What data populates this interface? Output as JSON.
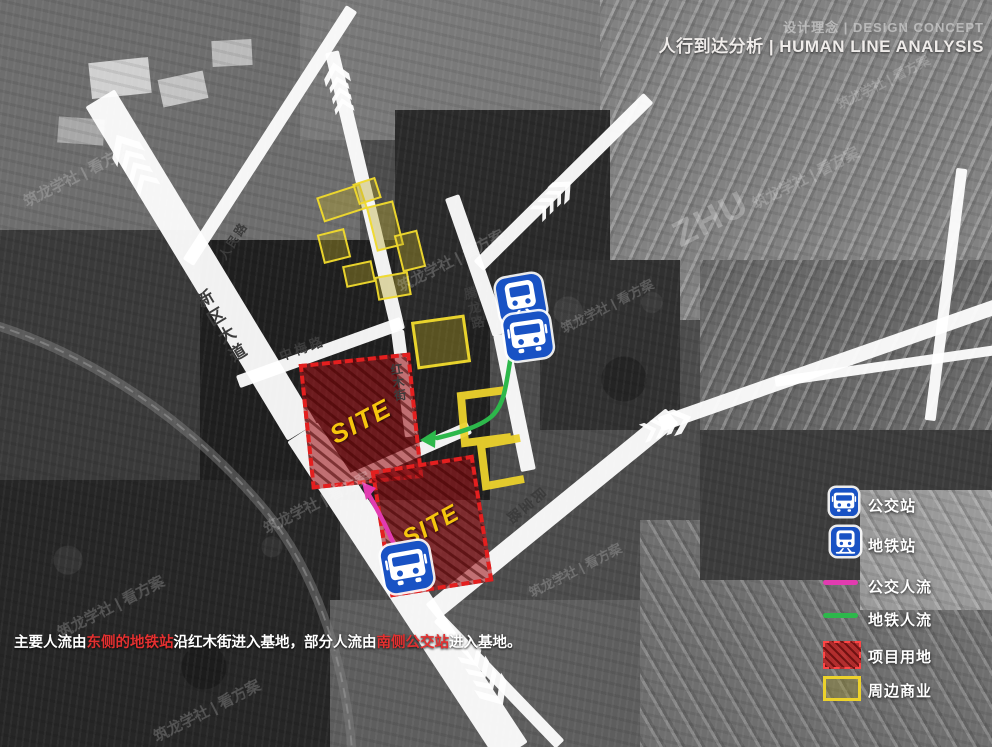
{
  "title": {
    "line1": "设计理念 | DESIGN CONCEPT",
    "line2": "人行到达分析 | HUMAN LINE ANALYSIS"
  },
  "annotation": {
    "part1": "主要人流由",
    "highlight1": "东侧的地铁站",
    "part2": "沿红木街进入基地，部分人流由",
    "highlight2": "南侧公交站",
    "part3": "进入基地。"
  },
  "legend": {
    "items": [
      {
        "label": "公交站",
        "type": "bus-station-icon",
        "color": "#1952c4"
      },
      {
        "label": "地铁站",
        "type": "metro-station-icon",
        "color": "#1952c4"
      },
      {
        "label": "公交人流",
        "type": "bus-flow-line",
        "color": "#e23bb0"
      },
      {
        "label": "地铁人流",
        "type": "metro-flow-line",
        "color": "#2db84b"
      },
      {
        "label": "项目用地",
        "type": "project-site-swatch",
        "color": "#c31e1e"
      },
      {
        "label": "周边商业",
        "type": "commercial-swatch",
        "color": "#ecd22c"
      }
    ]
  },
  "roads": {
    "xinqu": "新区大道",
    "renmin": "人民路",
    "zhongmei": "中梅路",
    "hongmu": "红木街",
    "tenglong": "腾龙路",
    "minbao": "民宝路"
  },
  "site": {
    "label": "SITE"
  },
  "watermark": {
    "brand": "ZHU",
    "text": "筑龙学社 | 看方案"
  },
  "colors": {
    "site_red": "#e41f1f",
    "commercial_yellow": "#ecd22c",
    "bus_flow_magenta": "#e23bb0",
    "metro_flow_green": "#2db84b",
    "station_blue": "#1952c4",
    "highlight_text_red": "#e33030"
  }
}
